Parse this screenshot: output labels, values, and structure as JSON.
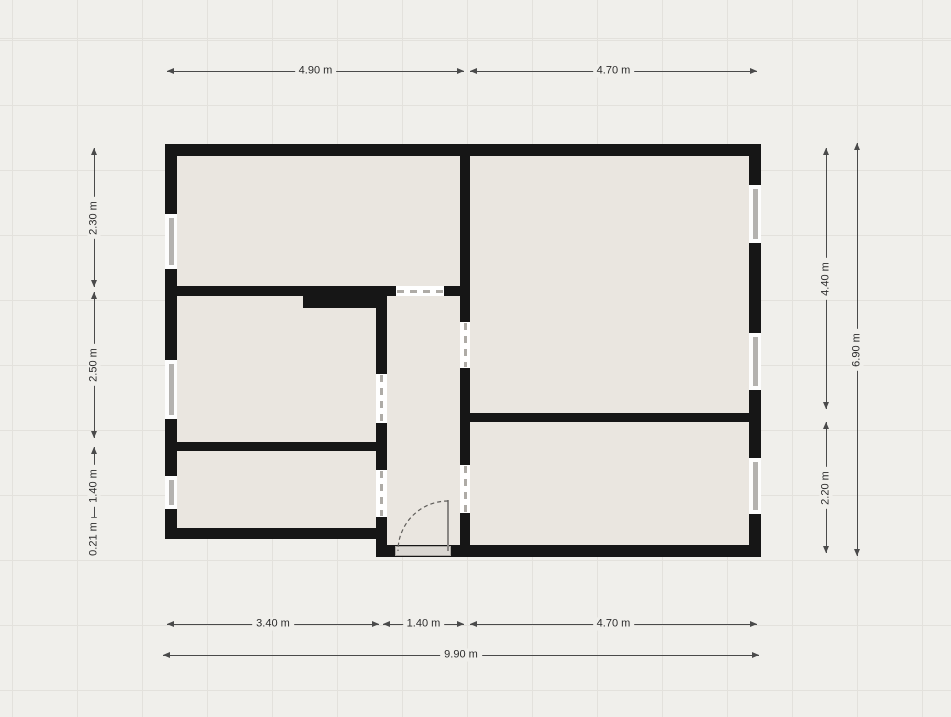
{
  "canvas": {
    "width": 951,
    "height": 717,
    "background": "#f0efeb",
    "grid_color": "#e3e1dc",
    "grid_size": 65,
    "grid_offset_x": 12,
    "grid_offset_y": 40
  },
  "palette": {
    "wall": "#161616",
    "room_fill": "#eae6e0",
    "window_bg": "#fdfdfd",
    "window_glass": "#b4b2af",
    "opening_bg": "#ffffff",
    "opening_dash": "#aeaba6",
    "dim_line": "#4a4a4a",
    "dim_text": "#2b2b2b",
    "threshold_fill": "#dad7d2",
    "threshold_border": "#aaa7a2",
    "door_leaf": "#8a8784",
    "swing_arc": "#5f5d5a"
  },
  "building": {
    "rooms": [
      {
        "name": "room-top-left",
        "x": 177,
        "y": 156,
        "w": 283,
        "h": 130
      },
      {
        "name": "room-middle-left",
        "x": 177,
        "y": 296,
        "w": 199,
        "h": 146
      },
      {
        "name": "room-bottom-left",
        "x": 177,
        "y": 451,
        "w": 199,
        "h": 77
      },
      {
        "name": "room-hallway",
        "x": 387,
        "y": 296,
        "w": 73,
        "h": 249
      },
      {
        "name": "room-top-right",
        "x": 470,
        "y": 156,
        "w": 279,
        "h": 257
      },
      {
        "name": "room-bottom-right",
        "x": 470,
        "y": 422,
        "w": 279,
        "h": 123
      }
    ],
    "walls": [
      {
        "name": "wall-exterior-top",
        "x": 165,
        "y": 144,
        "w": 596,
        "h": 12
      },
      {
        "name": "wall-exterior-left",
        "x": 165,
        "y": 144,
        "w": 12,
        "h": 395
      },
      {
        "name": "wall-exterior-right",
        "x": 749,
        "y": 144,
        "w": 12,
        "h": 413
      },
      {
        "name": "wall-exterior-bottom",
        "x": 376,
        "y": 545,
        "w": 385,
        "h": 12
      },
      {
        "name": "wall-exterior-bottom-left",
        "x": 165,
        "y": 528,
        "w": 222,
        "h": 11
      },
      {
        "name": "wall-hallway-left",
        "x": 376,
        "y": 286,
        "w": 11,
        "h": 271
      },
      {
        "name": "wall-central-vertical",
        "x": 460,
        "y": 144,
        "w": 10,
        "h": 413
      },
      {
        "name": "wall-top-left-divider",
        "x": 177,
        "y": 286,
        "w": 283,
        "h": 10
      },
      {
        "name": "wall-duct-block",
        "x": 303,
        "y": 286,
        "w": 84,
        "h": 22
      },
      {
        "name": "wall-left-lower-divider",
        "x": 177,
        "y": 442,
        "w": 199,
        "h": 9
      },
      {
        "name": "wall-right-divider",
        "x": 470,
        "y": 413,
        "w": 279,
        "h": 9
      }
    ],
    "windows": [
      {
        "name": "window-left-top",
        "x": 165,
        "y": 214,
        "w": 12,
        "h": 55,
        "orient": "v"
      },
      {
        "name": "window-left-middle",
        "x": 165,
        "y": 360,
        "w": 12,
        "h": 59,
        "orient": "v"
      },
      {
        "name": "window-left-bottom",
        "x": 165,
        "y": 476,
        "w": 12,
        "h": 33,
        "orient": "v"
      },
      {
        "name": "window-right-top",
        "x": 749,
        "y": 185,
        "w": 12,
        "h": 58,
        "orient": "v"
      },
      {
        "name": "window-right-middle",
        "x": 749,
        "y": 333,
        "w": 12,
        "h": 57,
        "orient": "v"
      },
      {
        "name": "window-right-bottom",
        "x": 749,
        "y": 458,
        "w": 12,
        "h": 56,
        "orient": "v"
      }
    ],
    "openings": [
      {
        "name": "doorway-hallway-north",
        "x": 396,
        "y": 286,
        "w": 48,
        "h": 10,
        "orient": "h"
      },
      {
        "name": "doorway-middle-left-room",
        "x": 376,
        "y": 374,
        "w": 11,
        "h": 49,
        "orient": "v"
      },
      {
        "name": "doorway-bottom-left-room",
        "x": 376,
        "y": 470,
        "w": 11,
        "h": 47,
        "orient": "v"
      },
      {
        "name": "doorway-top-right-room",
        "x": 460,
        "y": 322,
        "w": 10,
        "h": 46,
        "orient": "v"
      },
      {
        "name": "doorway-bottom-right-room",
        "x": 460,
        "y": 465,
        "w": 10,
        "h": 48,
        "orient": "v"
      }
    ],
    "entrance": {
      "threshold": {
        "x": 395,
        "y": 546,
        "w": 56,
        "h": 10
      },
      "leaf": {
        "x": 447,
        "y": 500,
        "w": 2,
        "h": 51
      },
      "arc": {
        "x": 396,
        "y": 499,
        "size": 54,
        "path": "M52 2 A50 50 0 0 0 2 52"
      }
    }
  },
  "dimensions": {
    "horizontal": [
      {
        "label": "4.90 m",
        "x1": 167,
        "x2": 464,
        "y": 71
      },
      {
        "label": "4.70 m",
        "x1": 470,
        "x2": 757,
        "y": 71
      },
      {
        "label": "3.40 m",
        "x1": 167,
        "x2": 379,
        "y": 624
      },
      {
        "label": "1.40 m",
        "x1": 383,
        "x2": 464,
        "y": 624
      },
      {
        "label": "4.70 m",
        "x1": 470,
        "x2": 757,
        "y": 624
      },
      {
        "label": "9.90 m",
        "x1": 163,
        "x2": 759,
        "y": 655
      }
    ],
    "vertical": [
      {
        "label": "2.30 m",
        "x": 94,
        "y1": 148,
        "y2": 438,
        "seg_end": 287
      },
      {
        "label": "2.50 m",
        "x": 94,
        "y1": 292,
        "y2": 438
      },
      {
        "label": "1.40 m",
        "x": 94,
        "y1": 447,
        "y2": 524
      },
      {
        "label": "0.21 m",
        "x": 94,
        "y1": 533,
        "y2": 556,
        "label_dy": -6
      },
      {
        "label": "4.40 m",
        "x": 826,
        "y1": 148,
        "y2": 409
      },
      {
        "label": "2.20 m",
        "x": 826,
        "y1": 422,
        "y2": 553
      },
      {
        "label": "6.90 m",
        "x": 857,
        "y1": 143,
        "y2": 556
      }
    ]
  }
}
